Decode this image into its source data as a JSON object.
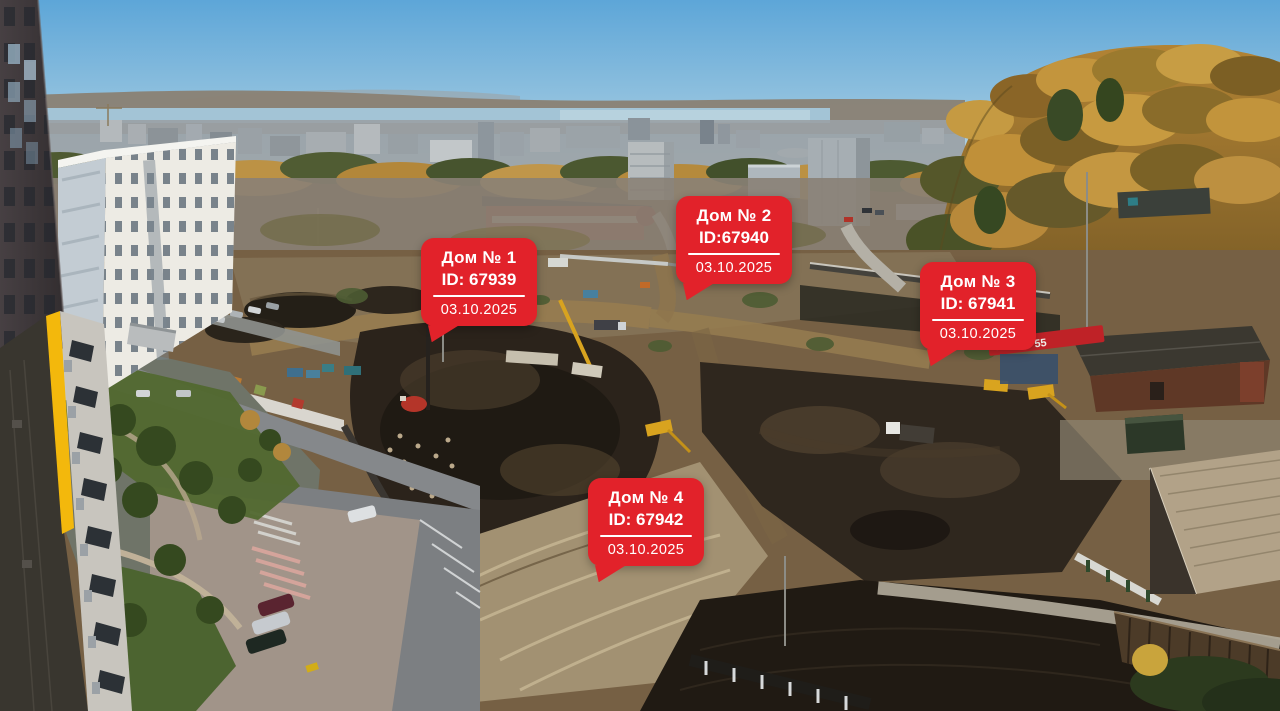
{
  "markers": [
    {
      "title": "Дом № 1",
      "id": "ID: 67939",
      "date": "03.10.2025"
    },
    {
      "title": "Дом № 2",
      "id": "ID:67940",
      "date": "03.10.2025"
    },
    {
      "title": "Дом № 3",
      "id": "ID: 67941",
      "date": "03.10.2025"
    },
    {
      "title": "Дом № 4",
      "id": "ID: 67942",
      "date": "03.10.2025"
    }
  ],
  "banner": {
    "partial_text": "55"
  },
  "colors": {
    "marker_red": "#e2222a",
    "marker_text": "#ffffff",
    "accent_yellow": "#f3b80c"
  }
}
